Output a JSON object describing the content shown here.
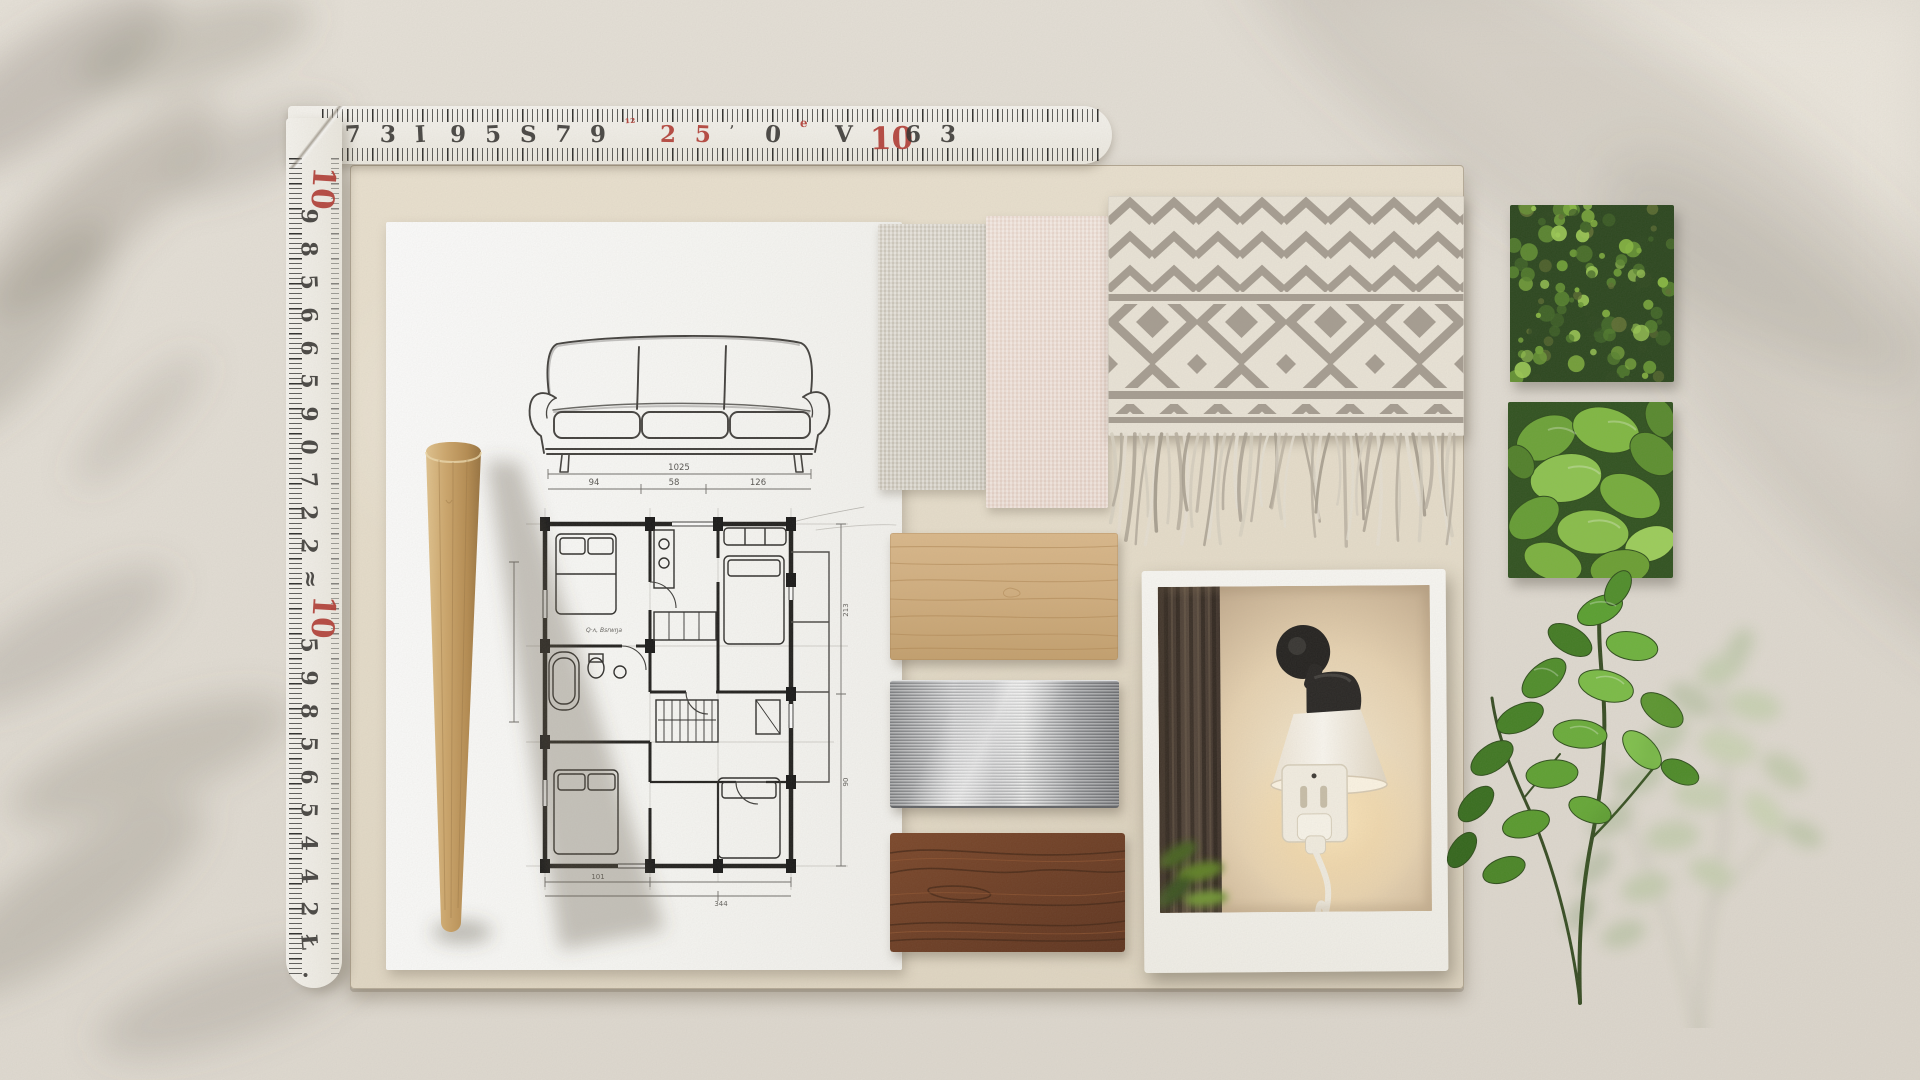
{
  "colors": {
    "concrete_bg": "#e5e0d7",
    "board_tan": "#e9e0cd",
    "paper_white": "#fbfaf7",
    "ruler_white": "#f5f3ed",
    "ruler_ink": "#2e2c29",
    "ruler_red": "#b23830",
    "leg_wood": "#c9a266",
    "linen_beige": "#dcd7cb",
    "linen_pink": "#f4e4db",
    "blanket_cream": "#ece6d9",
    "blanket_gray": "#a69d91",
    "oak_wood": "#d2ae7d",
    "brushed_metal": "#c2c3c6",
    "walnut_wood": "#6e3b22",
    "lamp_black": "#211f1d",
    "lamp_shade": "#f6efe3",
    "photo_wall_warm": "#eeD9b9",
    "moss_green": "#3c6323",
    "leaf_green": "#6fae38",
    "branch_green": "#57982c"
  },
  "rulers": {
    "horizontal": {
      "numbers": [
        {
          "t": "7"
        },
        {
          "t": "3"
        },
        {
          "t": "I"
        },
        {
          "t": "9"
        },
        {
          "t": "5"
        },
        {
          "t": "S"
        },
        {
          "t": "7"
        },
        {
          "t": "9"
        },
        {
          "t": "¹²",
          "c": "red",
          "small": true
        },
        {
          "t": "2",
          "c": "red"
        },
        {
          "t": "5",
          "c": "red"
        },
        {
          "t": ",",
          "small": true
        },
        {
          "t": "0"
        },
        {
          "t": "e",
          "c": "red",
          "small": true
        },
        {
          "t": "V"
        },
        {
          "t": "10",
          "c": "red",
          "big": true
        },
        {
          "t": "6"
        },
        {
          "t": "3"
        }
      ]
    },
    "vertical": {
      "numbers": [
        {
          "t": "10",
          "c": "red",
          "big": true
        },
        {
          "t": "9"
        },
        {
          "t": "8"
        },
        {
          "t": "5"
        },
        {
          "t": "6"
        },
        {
          "t": "6"
        },
        {
          "t": "5"
        },
        {
          "t": "9"
        },
        {
          "t": "0"
        },
        {
          "t": "7"
        },
        {
          "t": "2"
        },
        {
          "t": "2"
        },
        {
          "t": "≈"
        },
        {
          "t": "10",
          "c": "red",
          "big": true
        },
        {
          "t": "5"
        },
        {
          "t": "9"
        },
        {
          "t": "8"
        },
        {
          "t": "5"
        },
        {
          "t": "6"
        },
        {
          "t": "5"
        },
        {
          "t": "4"
        },
        {
          "t": "4"
        },
        {
          "t": "2"
        },
        {
          "t": "Ł"
        },
        {
          "t": "·"
        }
      ]
    }
  },
  "sketch": {
    "sofa_dim_total": "1025",
    "sofa_dim_parts": [
      "94",
      "58",
      "126"
    ],
    "plan_dims_right": [
      "213",
      "90"
    ],
    "plan_dims_bottom": [
      "101",
      "344"
    ],
    "plan_note": "Q·ʌ, Bsrwŋa"
  },
  "blanket": {
    "fringe_count": 50,
    "fringe_colors": [
      "#d8d1c2",
      "#b9b0a1",
      "#e7e1d4",
      "#a79e8f"
    ]
  },
  "moss_panel": {
    "blob_count": 120,
    "palette": [
      "#2a451c",
      "#3d6323",
      "#527f2a",
      "#6b9c33",
      "#86b83e",
      "#9ccb52",
      "#5a6b2e"
    ]
  }
}
